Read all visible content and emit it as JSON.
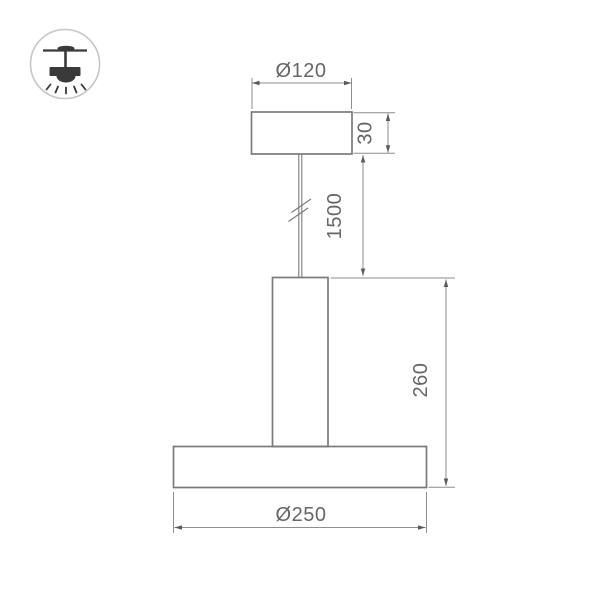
{
  "product": {
    "type": "pendant-lamp-technical-drawing"
  },
  "mount_icon": {
    "name": "ceiling-pendant-mount",
    "border_color": "#c6c6c6",
    "glyph_color": "#3a3a3a"
  },
  "drawing": {
    "line_color": "#7b7b7b",
    "dimension_line_color": "#8e8e8e",
    "text_color": "#666666",
    "background_color": "#ffffff",
    "dimensions": {
      "canopy_diameter": "Ø120",
      "canopy_height": "30",
      "cable_length": "1500",
      "body_height": "260",
      "base_diameter": "Ø250"
    }
  }
}
